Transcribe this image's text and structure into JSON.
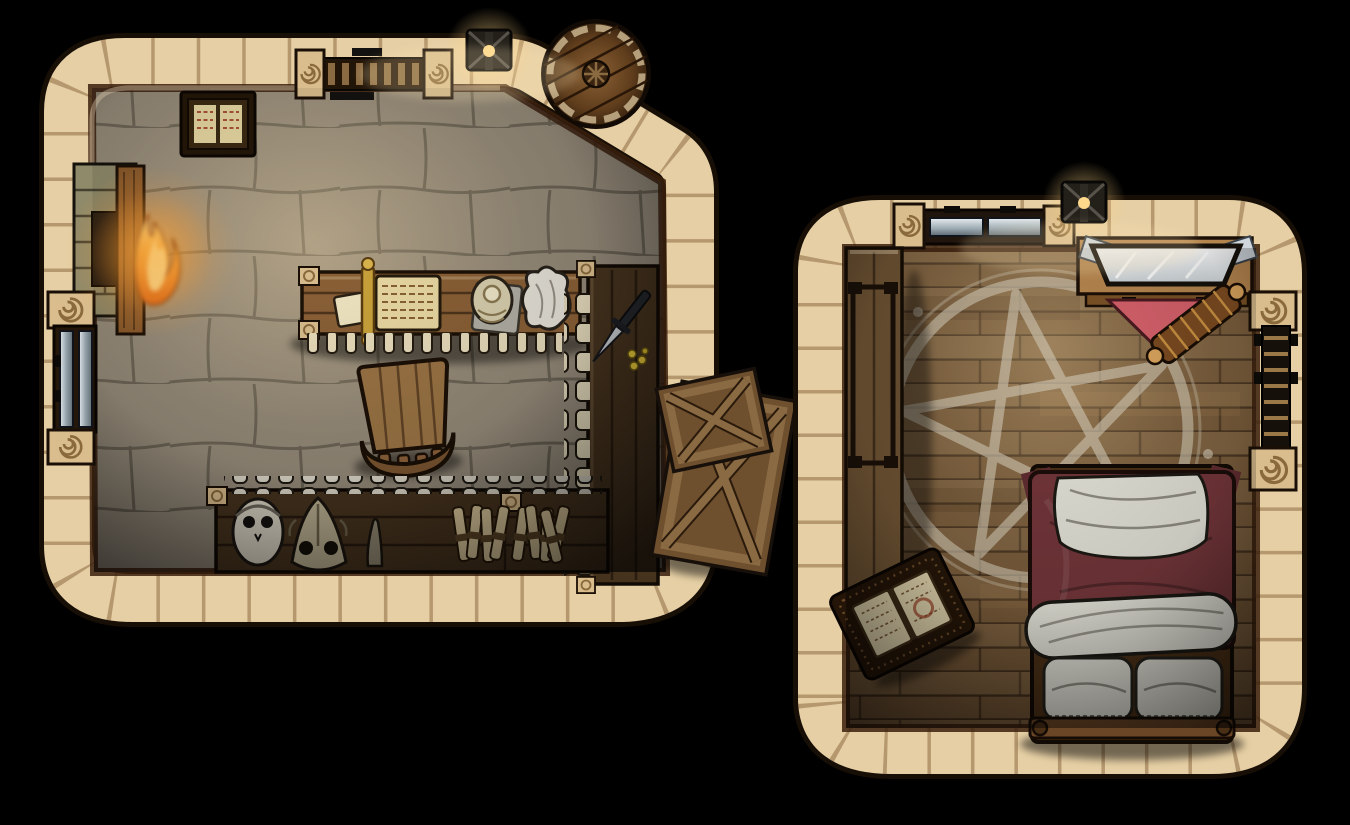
{
  "map": {
    "kind": "top-down fantasy battlemap",
    "between_rooms": [
      "stacked-wooden-crates"
    ],
    "rooms": [
      {
        "name": "workshop",
        "floor": "stone flagstones",
        "objects": [
          "fireplace-with-fire",
          "double-metal-door",
          "wall-mounted-open-book",
          "slatted-wall-window",
          "wall-lantern",
          "storage-barrel",
          "work-table",
          "open-scroll-with-rod",
          "loose-page",
          "skull-trinket-on-cloth",
          "cloth-pouch",
          "hanging-candle-row",
          "wooden-chair",
          "side-bench-with-candle-column",
          "black-dagger",
          "yellow-flowers",
          "workbench",
          "workbench-candle-row",
          "human-skull",
          "beast-skull",
          "horn-spike",
          "scroll-bundles"
        ]
      },
      {
        "name": "ritual-bedroom",
        "floor": "wooden planks",
        "objects": [
          "double-metal-window",
          "wall-lantern",
          "vanity-with-mirror",
          "corner-papers",
          "red-cloth",
          "ornate-scroll",
          "long-wall-bench",
          "chalk-pentagram",
          "ritual-book-on-stand",
          "bed-with-red-blanket",
          "white-top-sheet",
          "rolled-sheet",
          "pillows",
          "footboard",
          "ladder-window"
        ]
      }
    ]
  },
  "palette": {
    "wall_stone": "#e6cfa4",
    "wall_edge": "#170e06",
    "floor_stone": "#8a8173",
    "floor_wood": "#6f5233",
    "table_wood": "#8a6036",
    "dark_wood": "#46331e",
    "bench_wood": "#6b5132",
    "crate_wood": "#6e4f2e",
    "bed_blanket": "#713539",
    "ritual_cloth": "#d4606a",
    "linen": "#dfded4",
    "chalk": "#cdc3ae",
    "candle": "#e8dcbb",
    "bone": "#d8d2c2",
    "steel": "#aebac2",
    "gold": "#c9a23a",
    "fire": "#f59b2c"
  }
}
